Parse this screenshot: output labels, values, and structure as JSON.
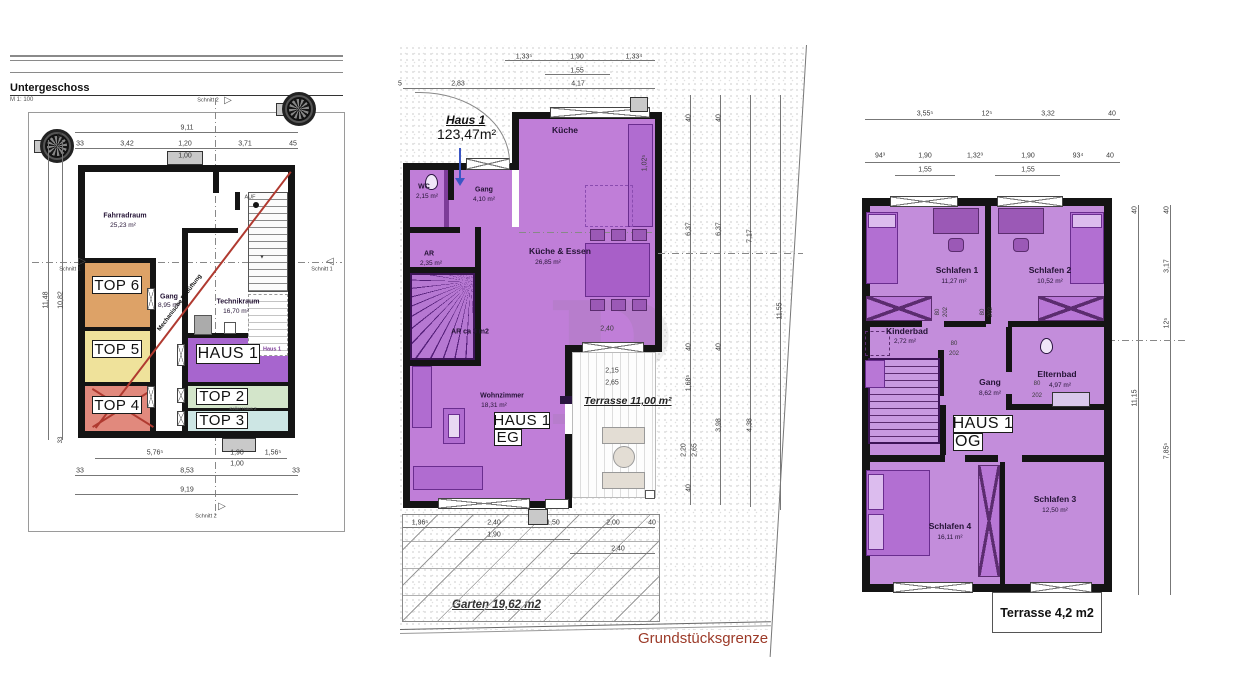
{
  "page": {
    "background": "#ffffff",
    "wall_color": "#141414",
    "boundary_color": "#9c3a28"
  },
  "basement": {
    "title": "Untergeschoss",
    "scale": "M 1: 100",
    "haus1_box": "HAUS 1",
    "top6": "TOP 6",
    "top5": "TOP 5",
    "top4": "TOP 4",
    "top2": "TOP 2",
    "top3": "TOP 3",
    "colors": {
      "top6": "#dda267",
      "top5": "#efe29b",
      "top4": "#e1897d",
      "haus1": "#a765ce",
      "top2": "#d3e5ca",
      "top3": "#cde6e4"
    },
    "labels": [
      {
        "t": "9,11",
        "x": 187,
        "y": 128,
        "cls": "dim"
      },
      {
        "t": "33",
        "x": 80,
        "y": 144,
        "cls": "dim"
      },
      {
        "t": "3,42",
        "x": 127,
        "y": 144,
        "cls": "dim"
      },
      {
        "t": "1,20",
        "x": 185,
        "y": 144,
        "cls": "dim"
      },
      {
        "t": "3,71",
        "x": 245,
        "y": 144,
        "cls": "dim"
      },
      {
        "t": "45",
        "x": 293,
        "y": 144,
        "cls": "dim"
      },
      {
        "t": "1,00",
        "x": 185,
        "y": 156,
        "cls": "dim"
      },
      {
        "t": "Fahrradraum",
        "x": 125,
        "y": 216,
        "cls": "rooms"
      },
      {
        "t": "25,23 m²",
        "x": 123,
        "y": 226,
        "cls": "area"
      },
      {
        "t": "AUF",
        "x": 250,
        "y": 198,
        "cls": "tiny"
      },
      {
        "t": "Gang",
        "x": 169,
        "y": 297,
        "cls": "rooms"
      },
      {
        "t": "8,95 m²",
        "x": 169,
        "y": 306,
        "cls": "area"
      },
      {
        "t": "Technikraum",
        "x": 238,
        "y": 302,
        "cls": "rooms"
      },
      {
        "t": "16,70 m²",
        "x": 236,
        "y": 312,
        "cls": "area"
      },
      {
        "t": "Haus 1",
        "x": 272,
        "y": 350,
        "cls": "microp"
      },
      {
        "t": "Keller Haus 2",
        "x": 243,
        "y": 409,
        "cls": "micro"
      },
      {
        "t": "5,76⁵",
        "x": 155,
        "y": 453,
        "cls": "dim"
      },
      {
        "t": "1,90",
        "x": 237,
        "y": 453,
        "cls": "dim"
      },
      {
        "t": "1,00",
        "x": 237,
        "y": 464,
        "cls": "dim"
      },
      {
        "t": "1,56⁵",
        "x": 273,
        "y": 453,
        "cls": "dim"
      },
      {
        "t": "33",
        "x": 80,
        "y": 471,
        "cls": "dim"
      },
      {
        "t": "8,53",
        "x": 187,
        "y": 471,
        "cls": "dim"
      },
      {
        "t": "33",
        "x": 296,
        "y": 471,
        "cls": "dim"
      },
      {
        "t": "9,19",
        "x": 187,
        "y": 490,
        "cls": "dim"
      },
      {
        "t": "11,48",
        "x": 46,
        "y": 300,
        "r": -90,
        "cls": "dim"
      },
      {
        "t": "10,82",
        "x": 61,
        "y": 300,
        "r": -90,
        "cls": "dim"
      },
      {
        "t": "33",
        "x": 61,
        "y": 136,
        "r": -90,
        "cls": "dim2"
      },
      {
        "t": "33",
        "x": 61,
        "y": 440,
        "r": -90,
        "cls": "dim2"
      },
      {
        "t": "Schnitt 2",
        "x": 208,
        "y": 101,
        "cls": "tiny"
      },
      {
        "t": "Schnitt 1",
        "x": 322,
        "y": 270,
        "cls": "tiny"
      },
      {
        "t": "Schnitt 1",
        "x": 70,
        "y": 270,
        "cls": "tiny"
      },
      {
        "t": "Schnitt 2",
        "x": 206,
        "y": 517,
        "cls": "tiny"
      },
      {
        "t": "▷",
        "x": 228,
        "y": 101,
        "cls": "arrowg"
      },
      {
        "t": "▷",
        "x": 82,
        "y": 262,
        "cls": "arrowg"
      },
      {
        "t": "◁",
        "x": 330,
        "y": 262,
        "cls": "arrowg"
      },
      {
        "t": "▷",
        "x": 222,
        "y": 507,
        "cls": "arrowg"
      },
      {
        "t": "▼",
        "x": 262,
        "y": 258,
        "cls": "tiny"
      },
      {
        "t": "Mechanische Entlüftung",
        "x": 180,
        "y": 303,
        "r": -53,
        "cls": "vent"
      }
    ]
  },
  "eg": {
    "haus1_title": "Haus 1",
    "haus1_area": "123,47m²",
    "haus_box": "HAUS 1",
    "floor_box": "EG",
    "terrasse": "Terrasse 11,00 m²",
    "garten": "Garten 19,62 m2",
    "grenze": "Grundstücksgrenze",
    "watermark": "P",
    "labels": [
      {
        "t": "1,33⁵",
        "x": 524,
        "y": 57,
        "cls": "dim"
      },
      {
        "t": "1,90",
        "x": 577,
        "y": 57,
        "cls": "dim"
      },
      {
        "t": "1,33⁴",
        "x": 634,
        "y": 57,
        "cls": "dim"
      },
      {
        "t": "1,55",
        "x": 577,
        "y": 71,
        "cls": "dim"
      },
      {
        "t": "5",
        "x": 400,
        "y": 84,
        "cls": "dim"
      },
      {
        "t": "2,83",
        "x": 458,
        "y": 84,
        "cls": "dim"
      },
      {
        "t": "4,17",
        "x": 578,
        "y": 84,
        "cls": "dim"
      },
      {
        "t": "Küche",
        "x": 565,
        "y": 130,
        "cls": "room"
      },
      {
        "t": "1,02⁵",
        "x": 645,
        "y": 163,
        "r": -90,
        "cls": "dim"
      },
      {
        "t": "WC",
        "x": 424,
        "y": 187,
        "cls": "rooms"
      },
      {
        "t": "2,15 m²",
        "x": 427,
        "y": 197,
        "cls": "area"
      },
      {
        "t": "Gang",
        "x": 484,
        "y": 190,
        "cls": "rooms"
      },
      {
        "t": "4,10 m²",
        "x": 484,
        "y": 200,
        "cls": "area"
      },
      {
        "t": "AR",
        "x": 429,
        "y": 254,
        "cls": "rooms"
      },
      {
        "t": "2,35 m²",
        "x": 431,
        "y": 264,
        "cls": "area"
      },
      {
        "t": "Küche & Essen",
        "x": 560,
        "y": 251,
        "cls": "room"
      },
      {
        "t": "26,85 m²",
        "x": 548,
        "y": 263,
        "cls": "area"
      },
      {
        "t": "AR ca 3 m2",
        "x": 470,
        "y": 332,
        "cls": "rooms"
      },
      {
        "t": "2,40",
        "x": 607,
        "y": 329,
        "cls": "dim"
      },
      {
        "t": "2,15",
        "x": 612,
        "y": 371,
        "cls": "dim"
      },
      {
        "t": "2,65",
        "x": 612,
        "y": 383,
        "cls": "dim"
      },
      {
        "t": "Wohnzimmer",
        "x": 502,
        "y": 396,
        "cls": "rooms"
      },
      {
        "t": "18,31 m²",
        "x": 494,
        "y": 406,
        "cls": "area"
      },
      {
        "t": "1,96⁵",
        "x": 420,
        "y": 523,
        "cls": "dim"
      },
      {
        "t": "2,40",
        "x": 494,
        "y": 523,
        "cls": "dim"
      },
      {
        "t": "1,90",
        "x": 494,
        "y": 535,
        "cls": "dim"
      },
      {
        "t": "1,50",
        "x": 553,
        "y": 523,
        "cls": "dim"
      },
      {
        "t": "2,00",
        "x": 613,
        "y": 523,
        "cls": "dim"
      },
      {
        "t": "40",
        "x": 652,
        "y": 523,
        "cls": "dim"
      },
      {
        "t": "2,40",
        "x": 618,
        "y": 549,
        "cls": "dim"
      },
      {
        "t": "40",
        "x": 689,
        "y": 118,
        "r": -90,
        "cls": "dim"
      },
      {
        "t": "6,37",
        "x": 689,
        "y": 229,
        "r": -90,
        "cls": "dim"
      },
      {
        "t": "40",
        "x": 689,
        "y": 347,
        "r": -90,
        "cls": "dim"
      },
      {
        "t": "1,68⁵",
        "x": 689,
        "y": 383,
        "r": -90,
        "cls": "dim"
      },
      {
        "t": "2,20",
        "x": 684,
        "y": 450,
        "r": -90,
        "cls": "dim"
      },
      {
        "t": "2,65",
        "x": 695,
        "y": 450,
        "r": -90,
        "cls": "dim"
      },
      {
        "t": "40",
        "x": 689,
        "y": 488,
        "r": -90,
        "cls": "dim"
      },
      {
        "t": "40",
        "x": 719,
        "y": 118,
        "r": -90,
        "cls": "dim"
      },
      {
        "t": "6,37",
        "x": 719,
        "y": 229,
        "r": -90,
        "cls": "dim"
      },
      {
        "t": "40",
        "x": 719,
        "y": 347,
        "r": -90,
        "cls": "dim"
      },
      {
        "t": "3,98",
        "x": 719,
        "y": 425,
        "r": -90,
        "cls": "dim"
      },
      {
        "t": "7,17",
        "x": 750,
        "y": 236,
        "r": -90,
        "cls": "dim"
      },
      {
        "t": "4,38",
        "x": 750,
        "y": 425,
        "r": -90,
        "cls": "dim"
      },
      {
        "t": "11,55",
        "x": 780,
        "y": 311,
        "r": -90,
        "cls": "dim"
      }
    ]
  },
  "og": {
    "haus_box": "HAUS 1",
    "floor_box": "OG",
    "terrasse": "Terrasse 4,2 m2",
    "labels": [
      {
        "t": "3,55⁵",
        "x": 925,
        "y": 114,
        "cls": "dim"
      },
      {
        "t": "12⁵",
        "x": 987,
        "y": 114,
        "cls": "dim"
      },
      {
        "t": "3,32",
        "x": 1048,
        "y": 114,
        "cls": "dim"
      },
      {
        "t": "40",
        "x": 1112,
        "y": 114,
        "cls": "dim"
      },
      {
        "t": "94³",
        "x": 880,
        "y": 156,
        "cls": "dim"
      },
      {
        "t": "1,90",
        "x": 925,
        "y": 156,
        "cls": "dim"
      },
      {
        "t": "1,32³",
        "x": 975,
        "y": 156,
        "cls": "dim"
      },
      {
        "t": "1,90",
        "x": 1028,
        "y": 156,
        "cls": "dim"
      },
      {
        "t": "93⁴",
        "x": 1078,
        "y": 156,
        "cls": "dim"
      },
      {
        "t": "40",
        "x": 1110,
        "y": 156,
        "cls": "dim"
      },
      {
        "t": "1,55",
        "x": 925,
        "y": 170,
        "cls": "dim"
      },
      {
        "t": "1,55",
        "x": 1028,
        "y": 170,
        "cls": "dim"
      },
      {
        "t": "Schlafen 1",
        "x": 957,
        "y": 270,
        "cls": "room"
      },
      {
        "t": "11,27 m²",
        "x": 954,
        "y": 282,
        "cls": "area"
      },
      {
        "t": "Schlafen 2",
        "x": 1050,
        "y": 270,
        "cls": "room"
      },
      {
        "t": "10,52 m²",
        "x": 1050,
        "y": 282,
        "cls": "area"
      },
      {
        "t": "Kinderbad",
        "x": 907,
        "y": 331,
        "cls": "room"
      },
      {
        "t": "2,72 m²",
        "x": 905,
        "y": 342,
        "cls": "area"
      },
      {
        "t": "80",
        "x": 938,
        "y": 312,
        "r": -90,
        "cls": "dim2"
      },
      {
        "t": "202",
        "x": 946,
        "y": 312,
        "r": -90,
        "cls": "dim2"
      },
      {
        "t": "80",
        "x": 983,
        "y": 312,
        "r": -90,
        "cls": "dim2"
      },
      {
        "t": "202",
        "x": 991,
        "y": 312,
        "r": -90,
        "cls": "dim2"
      },
      {
        "t": "80",
        "x": 954,
        "y": 344,
        "cls": "dim2"
      },
      {
        "t": "202",
        "x": 954,
        "y": 354,
        "cls": "dim2"
      },
      {
        "t": "Gang",
        "x": 990,
        "y": 382,
        "cls": "room"
      },
      {
        "t": "8,62 m²",
        "x": 990,
        "y": 394,
        "cls": "area"
      },
      {
        "t": "Elternbad",
        "x": 1057,
        "y": 374,
        "cls": "room"
      },
      {
        "t": "4,97 m²",
        "x": 1060,
        "y": 386,
        "cls": "area"
      },
      {
        "t": "80",
        "x": 1037,
        "y": 384,
        "cls": "dim2"
      },
      {
        "t": "202",
        "x": 1037,
        "y": 396,
        "cls": "dim2"
      },
      {
        "t": "Schlafen 3",
        "x": 1055,
        "y": 499,
        "cls": "room"
      },
      {
        "t": "12,50 m²",
        "x": 1055,
        "y": 511,
        "cls": "area"
      },
      {
        "t": "Schlafen 4",
        "x": 950,
        "y": 526,
        "cls": "room"
      },
      {
        "t": "16,11 m²",
        "x": 950,
        "y": 538,
        "cls": "area"
      },
      {
        "t": "40",
        "x": 1135,
        "y": 210,
        "r": -90,
        "cls": "dim"
      },
      {
        "t": "11,15",
        "x": 1135,
        "y": 398,
        "r": -90,
        "cls": "dim"
      },
      {
        "t": "40",
        "x": 1167,
        "y": 210,
        "r": -90,
        "cls": "dim"
      },
      {
        "t": "3,17",
        "x": 1167,
        "y": 266,
        "r": -90,
        "cls": "dim"
      },
      {
        "t": "12⁵",
        "x": 1167,
        "y": 323,
        "r": -90,
        "cls": "dim"
      },
      {
        "t": "7,85⁵",
        "x": 1167,
        "y": 451,
        "r": -90,
        "cls": "dim"
      }
    ]
  }
}
